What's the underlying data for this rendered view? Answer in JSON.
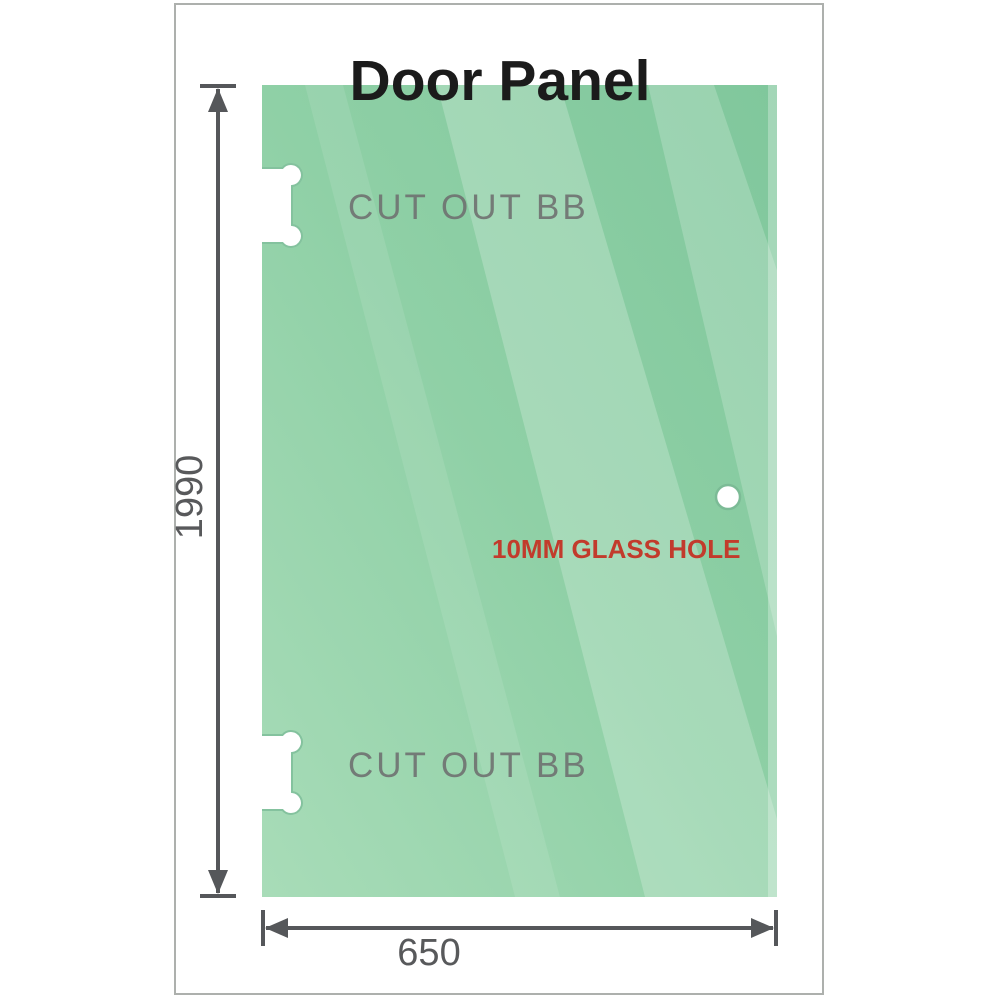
{
  "title": "Door Panel",
  "panel": {
    "name": "glass door panel",
    "height_label": "1990",
    "width_label": "650",
    "cutout_top_label": "CUT OUT BB",
    "cutout_bottom_label": "CUT OUT BB",
    "hole_label": "10MM GLASS HOLE"
  },
  "colors": {
    "glass_dark": "#80c79c",
    "glass_mid": "#8fd0a6",
    "glass_light": "#a8dcb8",
    "cutout_edge": "#84c29e",
    "hole_ring": "#7cbb96",
    "dimension": "#55575a",
    "number_gray": "#58595b",
    "label_gray": "#6f7271",
    "hole_red": "#c23b2c",
    "frame_border": "#adb0ad",
    "title_color": "#1b1b1b"
  }
}
